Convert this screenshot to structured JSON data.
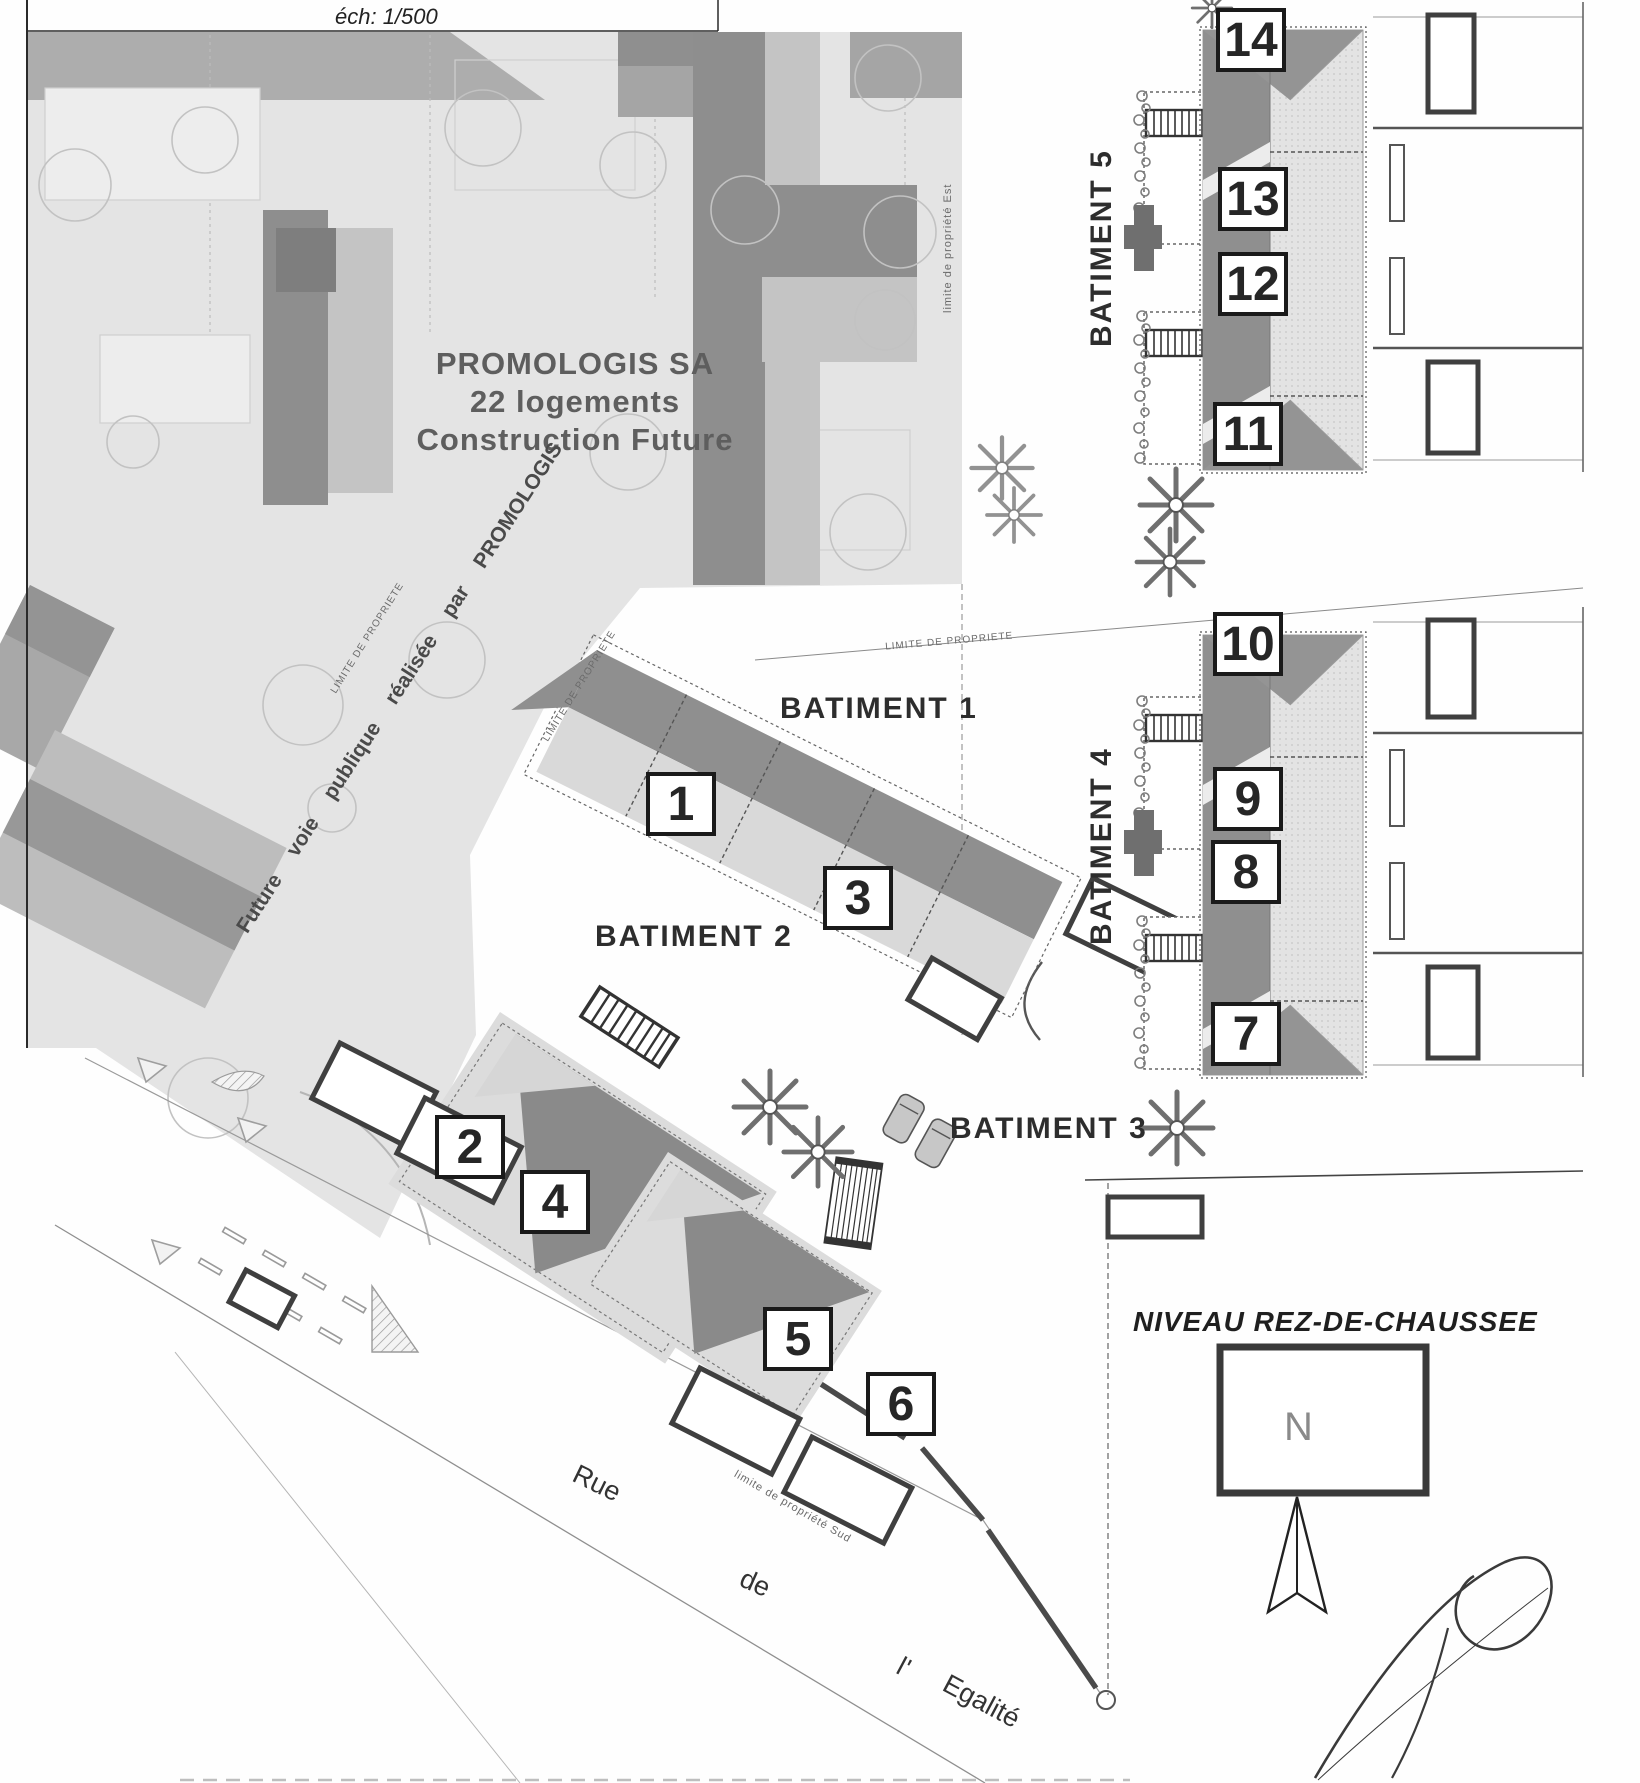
{
  "colors": {
    "ink": "#2a2a2a",
    "roof_dark": "#8f8f8f",
    "roof_mid": "#b9b9b9",
    "roof_light": "#e0e0e0",
    "zone_gray": "#e4e4e4",
    "box_border": "#1a1a1a"
  },
  "title": {
    "scale_label": "éch: 1/500"
  },
  "future_project": {
    "name": "PROMOLOGIS SA",
    "units_note": "22 logements",
    "status": "Construction Future",
    "road_label": "Future voie publique réalisée par PROMOLOGIS"
  },
  "buildings": {
    "b1": "BATIMENT 1",
    "b2": "BATIMENT 2",
    "b3": "BATIMENT 3",
    "b4": "BATIMENT 4",
    "b5": "BATIMENT 5"
  },
  "units": {
    "u1": "1",
    "u2": "2",
    "u3": "3",
    "u4": "4",
    "u5": "5",
    "u6": "6",
    "u7": "7",
    "u8": "8",
    "u9": "9",
    "u10": "10",
    "u11": "11",
    "u12": "12",
    "u13": "13",
    "u14": "14"
  },
  "boundaries": {
    "est": "limite de propriété Est",
    "sud": "limite de propriété Sud",
    "generic": "LIMITE DE PROPRIETE"
  },
  "street": {
    "word1": "Rue",
    "word2": "de",
    "word3": "l'",
    "word4": "Egalité"
  },
  "plan_note": {
    "niveau": "NIVEAU REZ-DE-CHAUSSEE",
    "north": "N"
  }
}
